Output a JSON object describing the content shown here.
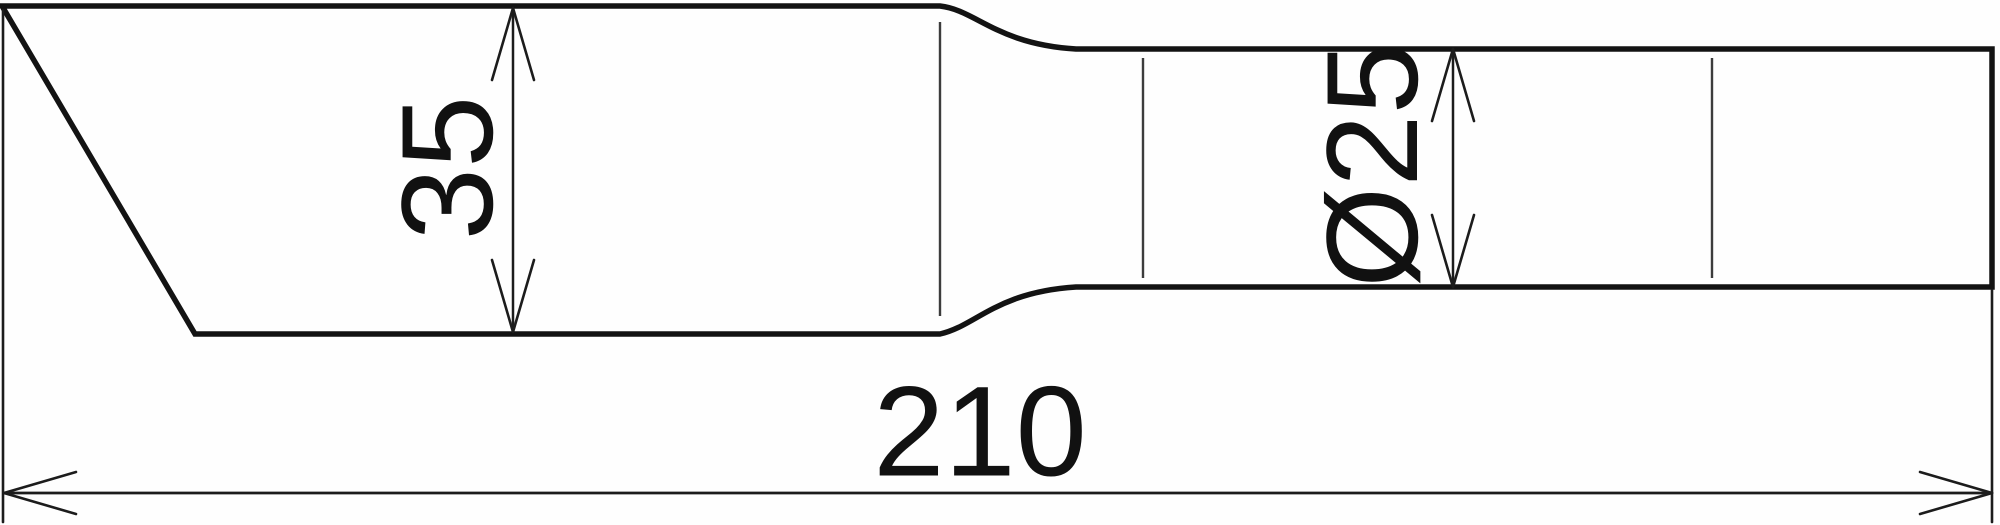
{
  "colors": {
    "outline": "#131313",
    "thin_line": "#3c3c3c",
    "dimension": "#1c1c1c",
    "text": "#111111",
    "background": "#fefefe"
  },
  "dimensions": {
    "height": {
      "label": "35"
    },
    "diameter": {
      "label": "Ø25"
    },
    "length": {
      "label": "210"
    }
  }
}
